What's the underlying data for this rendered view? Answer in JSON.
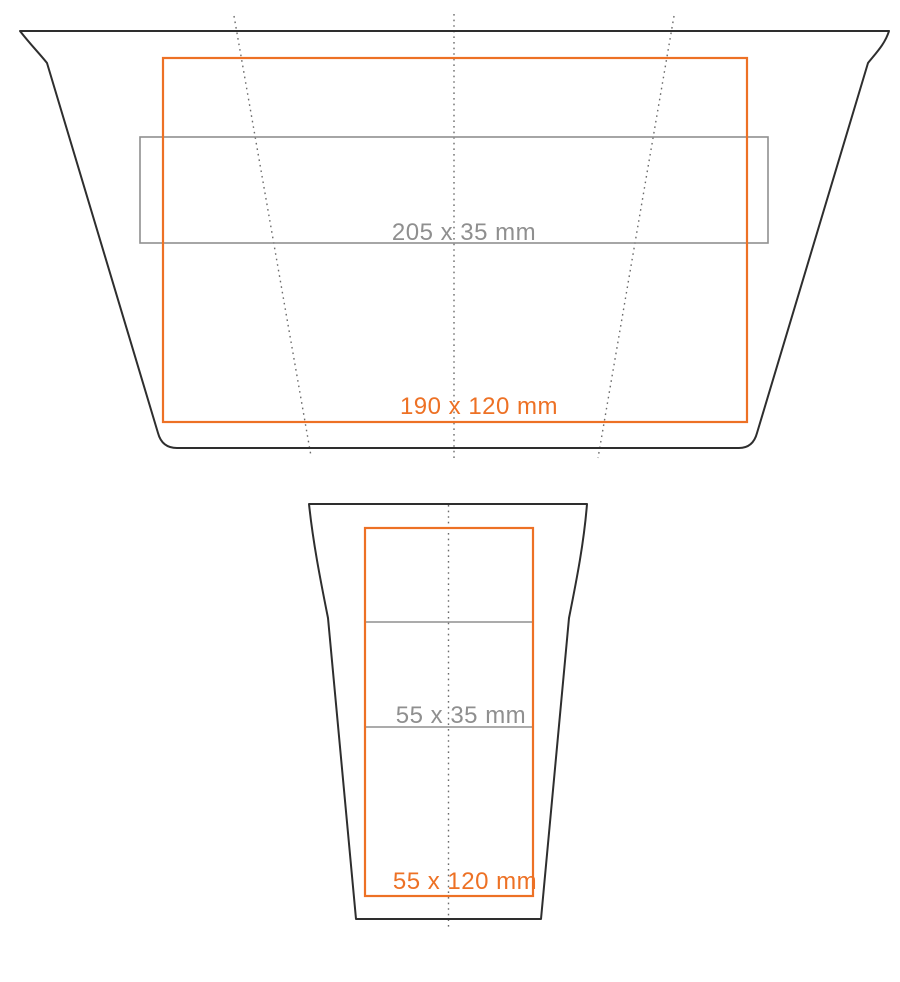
{
  "colors": {
    "outline": "#2e2e2e",
    "print_area": "#ed7125",
    "secondary_area": "#8f8f8f",
    "guide_line": "#6b6b6b"
  },
  "flat_view": {
    "print_area_label": "190 x 120 mm",
    "secondary_area_label": "205 x 35 mm"
  },
  "front_view": {
    "print_area_label": "55 x 120 mm",
    "secondary_area_label": "55 x 35 mm"
  }
}
